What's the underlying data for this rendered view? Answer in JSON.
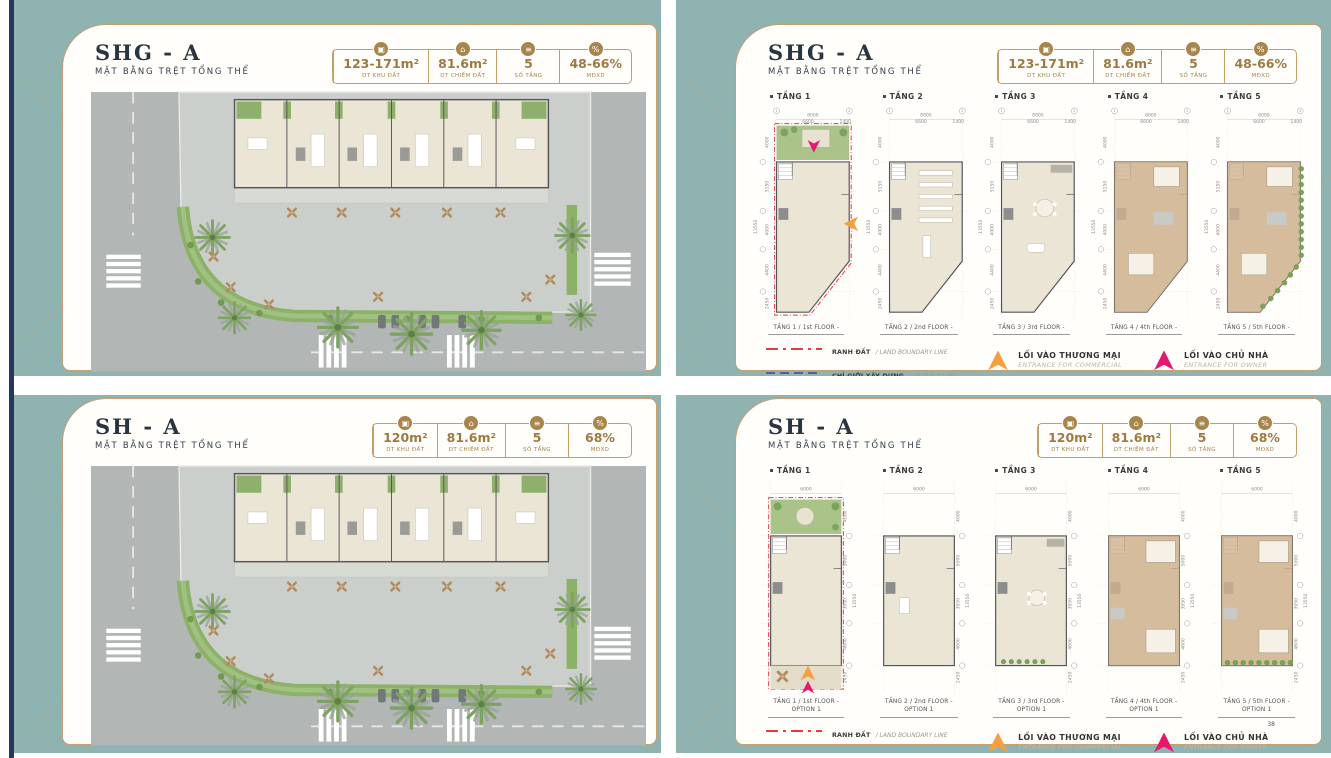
{
  "page_number": "38",
  "legend": {
    "boundary_vi": "RANH ĐẤT",
    "boundary_en": "/ LAND BOUNDARY LINE",
    "setback_vi": "CHỈ GIỚI XÂY DỰNG",
    "setback_en": "/ SETBACK LINE",
    "commercial_vi": "LỐI VÀO THƯƠNG MẠI",
    "commercial_en": "ENTRANCE FOR COMMERCIAL",
    "owner_vi": "LỐI VÀO CHỦ NHÀ",
    "owner_en": "ENTRANCE FOR OWNER"
  },
  "colors": {
    "teal": "#8fb3b0",
    "panel_border_gold": "#c69e6f",
    "stat_gold": "#9c7a42",
    "boundary_red": "#e23c3c",
    "setback_blue": "#4a5fb5",
    "commercial_orange": "#f5a040",
    "owner_pink": "#e5186e"
  },
  "panels": [
    {
      "title": "SHG - A",
      "subtitle": "MẶT BẰNG TRỆT TỔNG THỂ",
      "stats": [
        {
          "icon": "area-icon",
          "glyph": "▣",
          "value": "123-171m²",
          "label": "DT KHU ĐẤT"
        },
        {
          "icon": "footprint-icon",
          "glyph": "⌂",
          "value": "81.6m²",
          "label": "DT CHIẾM ĐẤT"
        },
        {
          "icon": "floor-count-icon",
          "glyph": "≡",
          "value": "5",
          "label": "SỐ TẦNG"
        },
        {
          "icon": "density-icon",
          "glyph": "%",
          "value": "48-66%",
          "label": "MĐXD"
        }
      ]
    },
    {
      "title": "SHG - A",
      "subtitle": "MẶT BẰNG TRỆT TỔNG THỂ",
      "stats": [
        {
          "icon": "area-icon",
          "glyph": "▣",
          "value": "123-171m²",
          "label": "DT KHU ĐẤT"
        },
        {
          "icon": "footprint-icon",
          "glyph": "⌂",
          "value": "81.6m²",
          "label": "DT CHIẾM ĐẤT"
        },
        {
          "icon": "floor-count-icon",
          "glyph": "≡",
          "value": "5",
          "label": "SỐ TẦNG"
        },
        {
          "icon": "density-icon",
          "glyph": "%",
          "value": "48-66%",
          "label": "MĐXD"
        }
      ],
      "dims": {
        "top_total": "8000",
        "top_a": "6600",
        "top_b": "1400",
        "left_0": "4000",
        "left_1": "5150",
        "left_2": "4000",
        "left_3": "4400",
        "left_4": "2450",
        "total": "13550"
      },
      "floors": [
        {
          "label": "TẦNG 1",
          "variant": "f1",
          "caption": "TẦNG 1 / 1st FLOOR -"
        },
        {
          "label": "TẦNG 2",
          "variant": "plain",
          "caption": "TẦNG 2 / 2nd FLOOR -"
        },
        {
          "label": "TẦNG 3",
          "variant": "living",
          "caption": "TẦNG 3 / 3rd FLOOR -"
        },
        {
          "label": "TẦNG 4",
          "variant": "bed",
          "caption": "TẦNG 4 / 4th FLOOR -"
        },
        {
          "label": "TẦNG 5",
          "variant": "bedgreen",
          "caption": "TẦNG 5 / 5th FLOOR -"
        }
      ]
    },
    {
      "title": "SH - A",
      "subtitle": "MẶT BẰNG TRỆT TỔNG THỂ",
      "stats": [
        {
          "icon": "area-icon",
          "glyph": "▣",
          "value": "120m²",
          "label": "DT KHU ĐẤT"
        },
        {
          "icon": "footprint-icon",
          "glyph": "⌂",
          "value": "81.6m²",
          "label": "DT CHIẾM ĐẤT"
        },
        {
          "icon": "floor-count-icon",
          "glyph": "≡",
          "value": "5",
          "label": "SỐ TẦNG"
        },
        {
          "icon": "density-icon",
          "glyph": "%",
          "value": "68%",
          "label": "MĐXD"
        }
      ]
    },
    {
      "title": "SH - A",
      "subtitle": "MẶT BẰNG TRỆT TỔNG THỂ",
      "stats": [
        {
          "icon": "area-icon",
          "glyph": "▣",
          "value": "120m²",
          "label": "DT KHU ĐẤT"
        },
        {
          "icon": "footprint-icon",
          "glyph": "⌂",
          "value": "81.6m²",
          "label": "DT CHIẾM ĐẤT"
        },
        {
          "icon": "floor-count-icon",
          "glyph": "≡",
          "value": "5",
          "label": "SỐ TẦNG"
        },
        {
          "icon": "density-icon",
          "glyph": "%",
          "value": "68%",
          "label": "MĐXD"
        }
      ],
      "dims": {
        "top_total": "6000",
        "left_0": "4000",
        "left_1": "5000",
        "left_2": "3950",
        "left_3": "4600",
        "left_4": "2450",
        "total": "13550"
      },
      "floors": [
        {
          "label": "TẦNG 1",
          "variant": "f1",
          "caption": "TẦNG 1 / 1st FLOOR -",
          "caption2": "OPTION 1"
        },
        {
          "label": "TẦNG 2",
          "variant": "plain",
          "caption": "TẦNG 2 / 2nd FLOOR -",
          "caption2": "OPTION 1"
        },
        {
          "label": "TẦNG 3",
          "variant": "living",
          "caption": "TẦNG 3 / 3rd FLOOR -",
          "caption2": "OPTION 1"
        },
        {
          "label": "TẦNG 4",
          "variant": "bed",
          "caption": "TẦNG 4 / 4th FLOOR -",
          "caption2": "OPTION 1"
        },
        {
          "label": "TẦNG 5",
          "variant": "bedgreen",
          "caption": "TẦNG 5 / 5th FLOOR -",
          "caption2": "OPTION 1"
        }
      ]
    }
  ]
}
